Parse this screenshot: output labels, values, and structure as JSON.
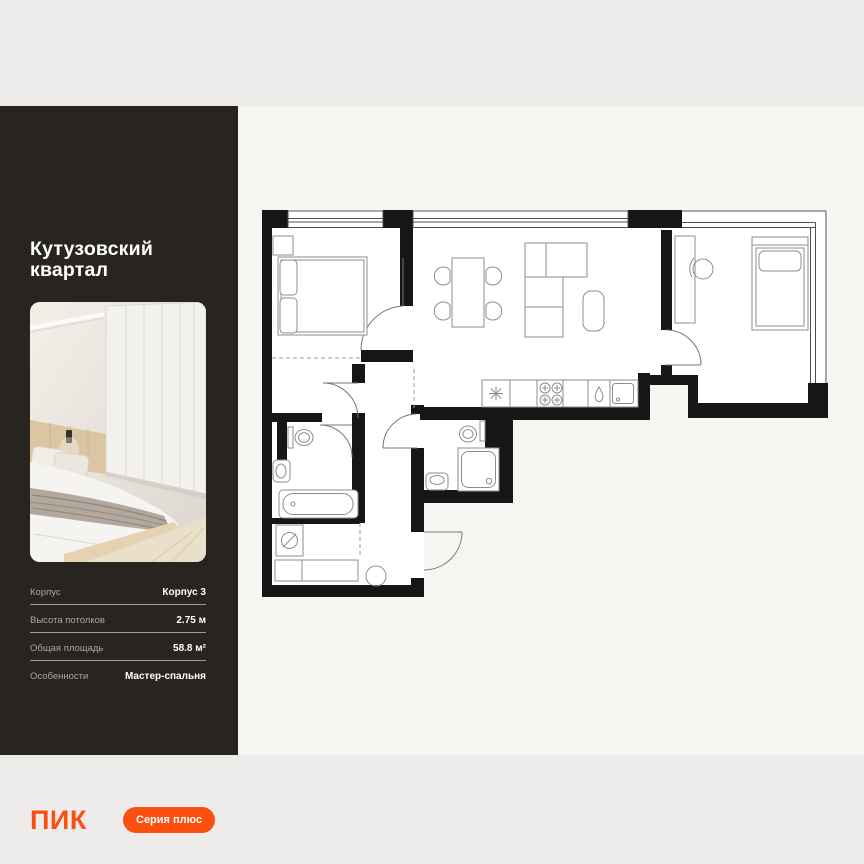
{
  "colors": {
    "accent": "#fa4f0e",
    "sidebar_bg": "#282420",
    "panel_bg": "#f6f5f2",
    "page_bg": "#edecea",
    "wall_black": "#161616"
  },
  "sidebar": {
    "title": "Кутузовский квартал",
    "specs": [
      {
        "label": "Корпус",
        "value": "Корпус 3"
      },
      {
        "label": "Высота потолков",
        "value": "2.75 м"
      },
      {
        "label": "Общая площадь",
        "value": "58.8 м²"
      },
      {
        "label": "Особенности",
        "value": "Мастер-спальня"
      }
    ],
    "logo": "ПИК",
    "badge": "Серия плюс"
  }
}
